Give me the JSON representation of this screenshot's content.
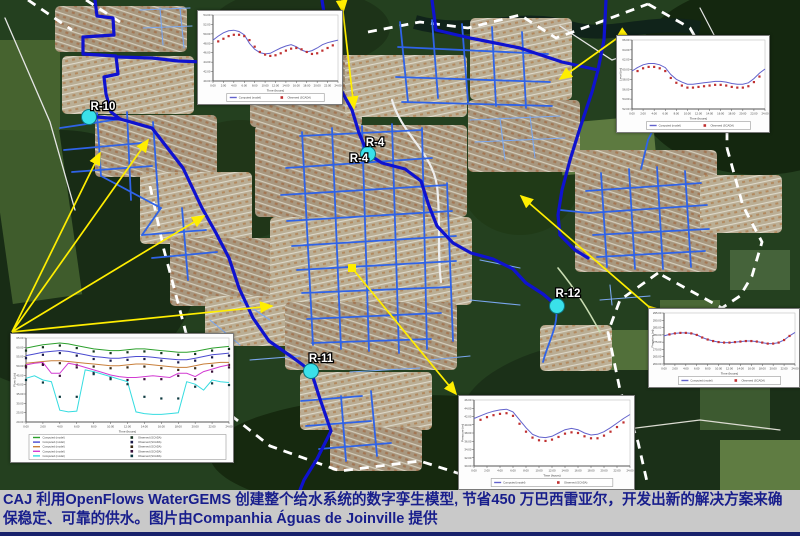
{
  "caption": {
    "text": "CAJ 利用OpenFlows WaterGEMS 创建整个给水系统的数字孪生模型, 节省450 万巴西雷亚尔，开发出新的解决方案来确保稳定、可靠的供水。图片由Companhia Águas de Joinville 提供"
  },
  "map": {
    "marker_color": "#3ae1ea",
    "marker_edge_color": "#0c7580",
    "callout_color": "#ffee00",
    "boundary_color": "#ffffff",
    "pipe_colors": {
      "main": "#0f12cf",
      "secondary": "#2f63e8",
      "minor": "#7aa7f0"
    },
    "nodes": [
      {
        "label": "R-10",
        "cx": 89,
        "cy": 117,
        "lx": 103,
        "ly": 110,
        "marker": true
      },
      {
        "label": "R-4",
        "cx": 368,
        "cy": 154,
        "lx": 375,
        "ly": 146,
        "marker": true
      },
      {
        "label": "R-4",
        "cx": 0,
        "cy": 0,
        "lx": 359,
        "ly": 162,
        "marker": false
      },
      {
        "label": "R-11",
        "cx": 311,
        "cy": 371,
        "lx": 321,
        "ly": 362,
        "marker": true
      },
      {
        "label": "R-12",
        "cx": 557,
        "cy": 306,
        "lx": 568,
        "ly": 297,
        "marker": true
      }
    ]
  },
  "chart_data": [
    {
      "id": "inset-top-middle",
      "type": "line",
      "x_ticks": [
        "0:00",
        "2:00",
        "4:00",
        "6:00",
        "8:00",
        "10:00",
        "12:00",
        "14:00",
        "16:00",
        "18:00",
        "20:00",
        "22:00",
        "24:00"
      ],
      "y_ticks": [
        "54.00",
        "52.00",
        "50.00",
        "48.00",
        "46.00",
        "44.00",
        "42.00",
        "40.00"
      ],
      "xlabel": "Time (hours)",
      "ylabel": "",
      "value_range": [
        0,
        100
      ],
      "series": [
        {
          "name": "Computed (model)",
          "kind": "line",
          "color": "#6262cc",
          "values": [
            62,
            68,
            73,
            76,
            77,
            75,
            70,
            57,
            48,
            43,
            41,
            42,
            46,
            50,
            53,
            55,
            52,
            47,
            44,
            46,
            50,
            55,
            58,
            60,
            62
          ]
        },
        {
          "name": "Observed (SCADA)",
          "kind": "scatter",
          "color": "#c03030",
          "values": [
            null,
            60,
            64,
            68,
            70,
            70,
            68,
            62,
            52,
            44,
            40,
            38,
            39,
            42,
            46,
            49,
            50,
            48,
            44,
            41,
            42,
            46,
            50,
            54,
            null
          ]
        }
      ],
      "legend": [
        {
          "swatch": "line",
          "color": "#6262cc",
          "label": "Computed (model)"
        },
        {
          "swatch": "square",
          "color": "#c03030",
          "label": "Observed (SCADA)"
        }
      ]
    },
    {
      "id": "inset-top-right",
      "type": "line",
      "x_ticks": [
        "0:00",
        "2:00",
        "4:00",
        "6:00",
        "8:00",
        "10:00",
        "12:00",
        "14:00",
        "16:00",
        "18:00",
        "20:00",
        "22:00",
        "24:00"
      ],
      "y_ticks": [
        "66.00",
        "64.00",
        "62.00",
        "60.00",
        "58.00",
        "56.00",
        "54.00",
        "52.00"
      ],
      "xlabel": "Time (hours)",
      "ylabel": "Level (m)",
      "value_range": [
        0,
        100
      ],
      "series": [
        {
          "name": "Computed (model)",
          "kind": "line",
          "color": "#6262cc",
          "values": [
            55,
            60,
            64,
            66,
            66,
            64,
            60,
            50,
            43,
            39,
            36,
            36,
            37,
            38,
            39,
            40,
            40,
            39,
            37,
            36,
            36,
            38,
            44,
            52,
            58
          ]
        },
        {
          "name": "Observed (SCADA)",
          "kind": "scatter",
          "color": "#c03030",
          "values": [
            null,
            55,
            59,
            61,
            61,
            59,
            55,
            45,
            38,
            34,
            31,
            31,
            32,
            33,
            34,
            35,
            35,
            34,
            32,
            31,
            31,
            33,
            39,
            47,
            null
          ]
        }
      ],
      "legend": [
        {
          "swatch": "line",
          "color": "#6262cc",
          "label": "Computed (model)"
        },
        {
          "swatch": "square",
          "color": "#c03030",
          "label": "Observed (SCADA)"
        }
      ]
    },
    {
      "id": "inset-right-middle",
      "type": "line",
      "x_ticks": [
        "0:00",
        "2:00",
        "4:00",
        "6:00",
        "8:00",
        "10:00",
        "12:00",
        "14:00",
        "16:00",
        "18:00",
        "20:00",
        "22:00",
        "24:00"
      ],
      "y_ticks": [
        "295.00",
        "290.00",
        "285.00",
        "280.00",
        "275.00",
        "270.00",
        "265.00",
        "260.00"
      ],
      "xlabel": "Time (hours)",
      "ylabel": "Pressure (m)",
      "value_range": [
        0,
        100
      ],
      "series": [
        {
          "name": "Computed (model)",
          "kind": "line",
          "color": "#6262cc",
          "values": [
            55,
            58,
            60,
            61,
            61,
            60,
            57,
            52,
            48,
            45,
            43,
            42,
            42,
            43,
            44,
            45,
            45,
            44,
            42,
            40,
            40,
            42,
            47,
            55,
            62
          ]
        },
        {
          "name": "Observed (SCADA)",
          "kind": "scatter",
          "color": "#c03030",
          "values": [
            null,
            58,
            60,
            61,
            61,
            60,
            57,
            52,
            48,
            45,
            43,
            42,
            42,
            43,
            44,
            45,
            45,
            44,
            42,
            40,
            40,
            42,
            47,
            55,
            null
          ]
        }
      ],
      "legend": [
        {
          "swatch": "line",
          "color": "#6262cc",
          "label": "Computed (model)"
        },
        {
          "swatch": "square",
          "color": "#c03030",
          "label": "Observed (SCADA)"
        }
      ]
    },
    {
      "id": "inset-bottom-middle",
      "type": "line",
      "x_ticks": [
        "0:00",
        "2:00",
        "4:00",
        "6:00",
        "8:00",
        "10:00",
        "12:00",
        "14:00",
        "16:00",
        "18:00",
        "20:00",
        "22:00",
        "24:00"
      ],
      "y_ticks": [
        "46.00",
        "44.00",
        "42.00",
        "40.00",
        "38.00",
        "36.00",
        "34.00",
        "32.00",
        "30.00"
      ],
      "xlabel": "Time (hours)",
      "ylabel": "Pressure (m)",
      "value_range": [
        0,
        100
      ],
      "series": [
        {
          "name": "Computed (model)",
          "kind": "line",
          "color": "#6262cc",
          "values": [
            72,
            76,
            80,
            83,
            85,
            86,
            82,
            70,
            58,
            48,
            44,
            43,
            45,
            50,
            55,
            57,
            55,
            50,
            47,
            48,
            52,
            58,
            65,
            72,
            78
          ]
        },
        {
          "name": "Observed (SCADA)",
          "kind": "scatter",
          "color": "#c03030",
          "values": [
            null,
            70,
            74,
            77,
            79,
            80,
            76,
            64,
            52,
            43,
            39,
            38,
            40,
            44,
            49,
            51,
            50,
            45,
            42,
            42,
            46,
            52,
            59,
            66,
            null
          ]
        }
      ],
      "legend": [
        {
          "swatch": "line",
          "color": "#6262cc",
          "label": "Computed (model)"
        },
        {
          "swatch": "square",
          "color": "#c03030",
          "label": "Observed (SCADA)"
        }
      ]
    },
    {
      "id": "inset-bottom-left",
      "type": "line",
      "x_ticks": [
        "0:00",
        "2:00",
        "4:00",
        "6:00",
        "8:00",
        "10:00",
        "12:00",
        "14:00",
        "16:00",
        "18:00",
        "20:00",
        "22:00",
        "24:00"
      ],
      "y_ticks": [
        "65.00",
        "60.00",
        "55.00",
        "50.00",
        "45.00",
        "40.00",
        "35.00",
        "30.00",
        "25.00",
        "20.00"
      ],
      "xlabel": "Time (hours)",
      "ylabel": "Flow (L/s)",
      "value_range": [
        0,
        100
      ],
      "series": [
        {
          "name": "Computed (model)",
          "kind": "line",
          "color": "#2ca02c",
          "values": [
            88,
            90,
            92,
            93,
            94,
            93,
            91,
            89,
            87,
            86,
            85,
            85,
            86,
            87,
            87,
            86,
            85,
            84,
            83,
            83,
            84,
            86,
            88,
            89,
            90
          ]
        },
        {
          "name": "Observed (SCADA)",
          "kind": "scatter",
          "color": "#14321e",
          "values": [
            85,
            null,
            89,
            null,
            91,
            null,
            88,
            null,
            84,
            null,
            82,
            null,
            83,
            null,
            84,
            null,
            82,
            null,
            80,
            null,
            81,
            null,
            85,
            null,
            87
          ]
        },
        {
          "name": "Computed (model)",
          "kind": "line",
          "color": "#4a4ad0",
          "values": [
            79,
            81,
            83,
            84,
            85,
            84,
            82,
            80,
            78,
            77,
            76,
            76,
            77,
            78,
            78,
            77,
            76,
            75,
            74,
            74,
            76,
            78,
            80,
            81,
            82
          ]
        },
        {
          "name": "Observed (SCADA)",
          "kind": "scatter",
          "color": "#1a1a4a",
          "values": [
            76,
            null,
            80,
            null,
            82,
            null,
            79,
            null,
            75,
            null,
            73,
            null,
            74,
            null,
            75,
            null,
            73,
            null,
            71,
            null,
            73,
            null,
            77,
            null,
            79
          ]
        },
        {
          "name": "Computed (model)",
          "kind": "line",
          "color": "#c87f3a",
          "values": [
            70,
            71,
            72,
            73,
            73,
            72,
            71,
            70,
            69,
            68,
            67,
            67,
            68,
            69,
            69,
            68,
            67,
            66,
            65,
            65,
            67,
            69,
            70,
            71,
            71
          ]
        },
        {
          "name": "Observed (SCADA)",
          "kind": "scatter",
          "color": "#3a2a14",
          "values": [
            67,
            null,
            69,
            null,
            70,
            null,
            68,
            null,
            66,
            null,
            64,
            null,
            65,
            null,
            66,
            null,
            64,
            null,
            62,
            null,
            64,
            null,
            67,
            null,
            68
          ]
        },
        {
          "name": "Computed (model)",
          "kind": "line",
          "color": "#d23bd2",
          "values": [
            68,
            70,
            71,
            58,
            58,
            70,
            68,
            65,
            62,
            59,
            56,
            54,
            53,
            53,
            54,
            55,
            54,
            53,
            58,
            58,
            54,
            60,
            63,
            66,
            68
          ]
        },
        {
          "name": "Observed (SCADA)",
          "kind": "scatter",
          "color": "#3a103a",
          "values": [
            65,
            null,
            68,
            null,
            55,
            null,
            65,
            null,
            59,
            null,
            53,
            null,
            50,
            null,
            51,
            null,
            51,
            null,
            55,
            null,
            51,
            null,
            60,
            null,
            65
          ]
        },
        {
          "name": "Computed (model)",
          "kind": "line",
          "color": "#35dce0",
          "values": [
            52,
            55,
            50,
            48,
            14,
            12,
            13,
            62,
            60,
            57,
            54,
            51,
            48,
            12,
            10,
            9,
            9,
            10,
            11,
            48,
            45,
            38,
            50,
            48,
            47
          ]
        },
        {
          "name": "Observed (SCADA)",
          "kind": "scatter",
          "color": "#0e3a40",
          "values": [
            50,
            null,
            47,
            null,
            30,
            null,
            30,
            null,
            57,
            null,
            51,
            null,
            45,
            null,
            30,
            null,
            28,
            null,
            28,
            null,
            42,
            null,
            46,
            null,
            44
          ]
        }
      ],
      "legend": [
        {
          "swatch": "line",
          "color": "#2ca02c",
          "label": "Computed (model)"
        },
        {
          "swatch": "square",
          "color": "#14321e",
          "label": "Observed (SCADA)"
        },
        {
          "swatch": "line",
          "color": "#4a4ad0",
          "label": "Computed (model)"
        },
        {
          "swatch": "square",
          "color": "#1a1a4a",
          "label": "Observed (SCADA)"
        },
        {
          "swatch": "line",
          "color": "#c87f3a",
          "label": "Computed (model)"
        },
        {
          "swatch": "square",
          "color": "#3a2a14",
          "label": "Observed (SCADA)"
        },
        {
          "swatch": "line",
          "color": "#d23bd2",
          "label": "Computed (model)"
        },
        {
          "swatch": "square",
          "color": "#3a103a",
          "label": "Observed (SCADA)"
        },
        {
          "swatch": "line",
          "color": "#35dce0",
          "label": "Computed (model)"
        },
        {
          "swatch": "square",
          "color": "#0e3a40",
          "label": "Observed (SCADA)"
        }
      ]
    }
  ]
}
